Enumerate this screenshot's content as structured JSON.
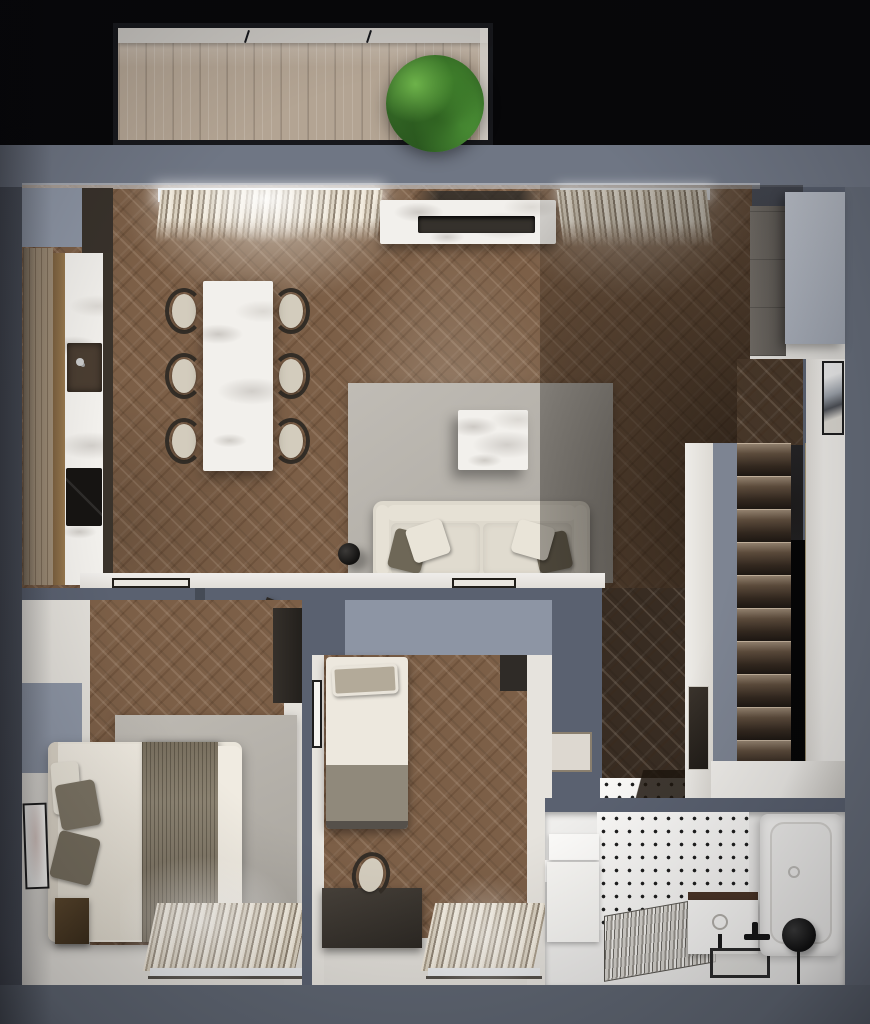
{
  "meta": {
    "title": "apartment-floor-plan-3d-top-view",
    "style": "photorealistic top-down architectural render, no text labels"
  },
  "rooms": [
    {
      "name": "balcony",
      "features": [
        "wood-plank-deck",
        "potted-plant",
        "glass-rail-frame"
      ]
    },
    {
      "name": "open-living-dining-kitchen",
      "features": [
        "tall-wood-cabinets",
        "marble-counter",
        "sink",
        "black-cooktop",
        "marble-dining-table",
        "six-chairs",
        "two-windows-with-vertical-blinds",
        "marble-media-console",
        "gray-area-rug",
        "square-marble-coffee-table",
        "cream-sofa-with-pillows",
        "black-floor-lamp",
        "gray-wardrobe"
      ]
    },
    {
      "name": "bedroom",
      "features": [
        "double-bed-white-duvet",
        "olive-throw-blanket",
        "olive-pillows",
        "dark-nightstand",
        "leaning-framed-art",
        "gray-rug",
        "window-with-blinds",
        "open-door"
      ]
    },
    {
      "name": "second-bedroom",
      "features": [
        "single-bed",
        "dark-desk",
        "chair",
        "framed-art",
        "window-with-blinds",
        "dark-wardrobe"
      ]
    },
    {
      "name": "hallway",
      "features": [
        "dark-herringbone-floor",
        "wall-niche",
        "framed-art"
      ]
    },
    {
      "name": "staircase",
      "features": [
        "ten-dark-wood-steps",
        "white-landing",
        "side-void"
      ]
    },
    {
      "name": "bathroom",
      "features": [
        "black-dot-mosaic-floor",
        "bathtub",
        "black-faucet",
        "black-round-stool",
        "vanity-with-sink",
        "glass-shower-screen",
        "towel-radiator",
        "storage-cabinets"
      ]
    }
  ],
  "palette": {
    "wallTop": "#6f7684",
    "wallLeft": "#4d525d",
    "wallRight": "#666d7a",
    "wallBottom": "#5f6672",
    "wallMid": "#5a6170",
    "wallFace": "#8d95a4",
    "floorMain": "#7c5f47",
    "floorDark": "#463628",
    "floorHall": "#382c22",
    "deck": "#b3a493",
    "marble": "#f2f0ec",
    "tile": "#f8f7f5",
    "rug": "#b8b4ad",
    "sofa": "#ded9cd",
    "pillowOlive": "#6e6757",
    "pillowCream": "#e9e4d8",
    "plantGreen": "#3f7d2b",
    "background": "#070709"
  }
}
